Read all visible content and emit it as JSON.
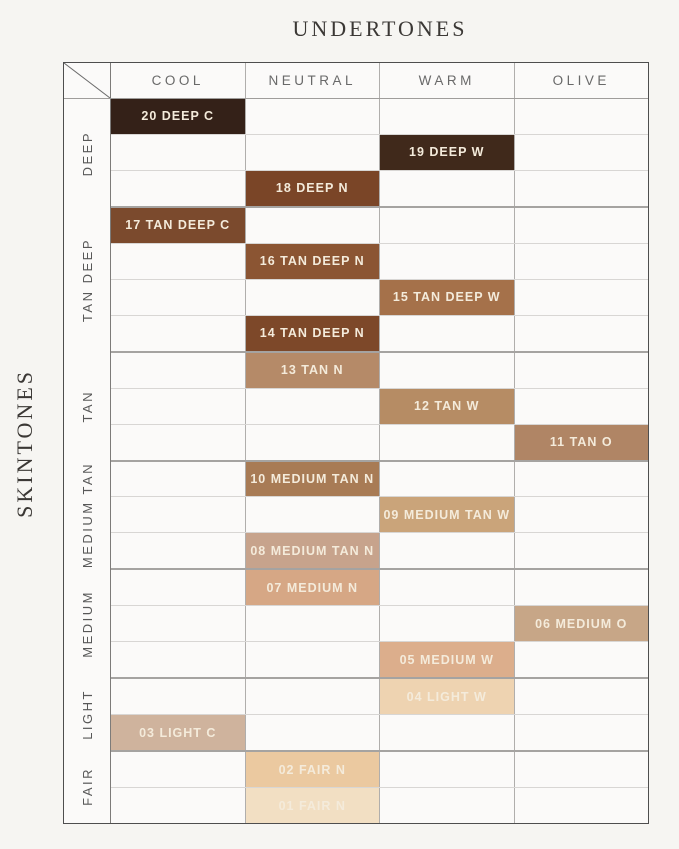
{
  "chart_data": {
    "type": "table",
    "title": "UNDERTONES",
    "ylabel": "SKINTONES",
    "columns": [
      "COOL",
      "NEUTRAL",
      "WARM",
      "OLIVE"
    ],
    "groups": [
      {
        "label": "DEEP",
        "rows": 3
      },
      {
        "label": "TAN DEEP",
        "rows": 4
      },
      {
        "label": "TAN",
        "rows": 3
      },
      {
        "label": "MEDIUM TAN",
        "rows": 3
      },
      {
        "label": "MEDIUM",
        "rows": 3
      },
      {
        "label": "LIGHT",
        "rows": 2
      },
      {
        "label": "FAIR",
        "rows": 2
      }
    ],
    "shades": [
      {
        "label": "20 DEEP C",
        "skintone": "DEEP",
        "undertone": "COOL",
        "color": "#342118"
      },
      {
        "label": "19 DEEP W",
        "skintone": "DEEP",
        "undertone": "WARM",
        "color": "#40291b"
      },
      {
        "label": "18 DEEP N",
        "skintone": "DEEP",
        "undertone": "NEUTRAL",
        "color": "#7a4527"
      },
      {
        "label": "17 TAN DEEP C",
        "skintone": "TAN DEEP",
        "undertone": "COOL",
        "color": "#7b4a2d"
      },
      {
        "label": "16 TAN DEEP N",
        "skintone": "TAN DEEP",
        "undertone": "NEUTRAL",
        "color": "#8b5533"
      },
      {
        "label": "15 TAN DEEP W",
        "skintone": "TAN DEEP",
        "undertone": "WARM",
        "color": "#a5714a"
      },
      {
        "label": "14 TAN DEEP N",
        "skintone": "TAN DEEP",
        "undertone": "NEUTRAL",
        "color": "#7d4829"
      },
      {
        "label": "13 TAN N",
        "skintone": "TAN",
        "undertone": "NEUTRAL",
        "color": "#b58a68"
      },
      {
        "label": "12 TAN W",
        "skintone": "TAN",
        "undertone": "WARM",
        "color": "#b68c64"
      },
      {
        "label": "11 TAN O",
        "skintone": "TAN",
        "undertone": "OLIVE",
        "color": "#b08565"
      },
      {
        "label": "10 MEDIUM TAN N",
        "skintone": "MEDIUM TAN",
        "undertone": "NEUTRAL",
        "color": "#a87b55"
      },
      {
        "label": "09 MEDIUM TAN W",
        "skintone": "MEDIUM TAN",
        "undertone": "WARM",
        "color": "#caa47a"
      },
      {
        "label": "08 MEDIUM TAN N",
        "skintone": "MEDIUM TAN",
        "undertone": "NEUTRAL",
        "color": "#c7a38c"
      },
      {
        "label": "07 MEDIUM N",
        "skintone": "MEDIUM",
        "undertone": "NEUTRAL",
        "color": "#d6a785"
      },
      {
        "label": "06 MEDIUM O",
        "skintone": "MEDIUM",
        "undertone": "OLIVE",
        "color": "#c7a687"
      },
      {
        "label": "05 MEDIUM W",
        "skintone": "MEDIUM",
        "undertone": "WARM",
        "color": "#dcae8c"
      },
      {
        "label": "04 LIGHT W",
        "skintone": "LIGHT",
        "undertone": "WARM",
        "color": "#eed3b1"
      },
      {
        "label": "03 LIGHT C",
        "skintone": "LIGHT",
        "undertone": "COOL",
        "color": "#cfb39d"
      },
      {
        "label": "02 FAIR N",
        "skintone": "FAIR",
        "undertone": "NEUTRAL",
        "color": "#ebc9a0"
      },
      {
        "label": "01 FAIR N",
        "skintone": "FAIR",
        "undertone": "NEUTRAL",
        "color": "#f2dfc3"
      }
    ]
  },
  "colors": {
    "background": "#f6f5f2",
    "cell_background": "#fbfaf9",
    "shade_text": "#f4ebdb",
    "header_text": "#696969",
    "title_text": "#3b3835",
    "grid_border": "#4e4e4e"
  }
}
